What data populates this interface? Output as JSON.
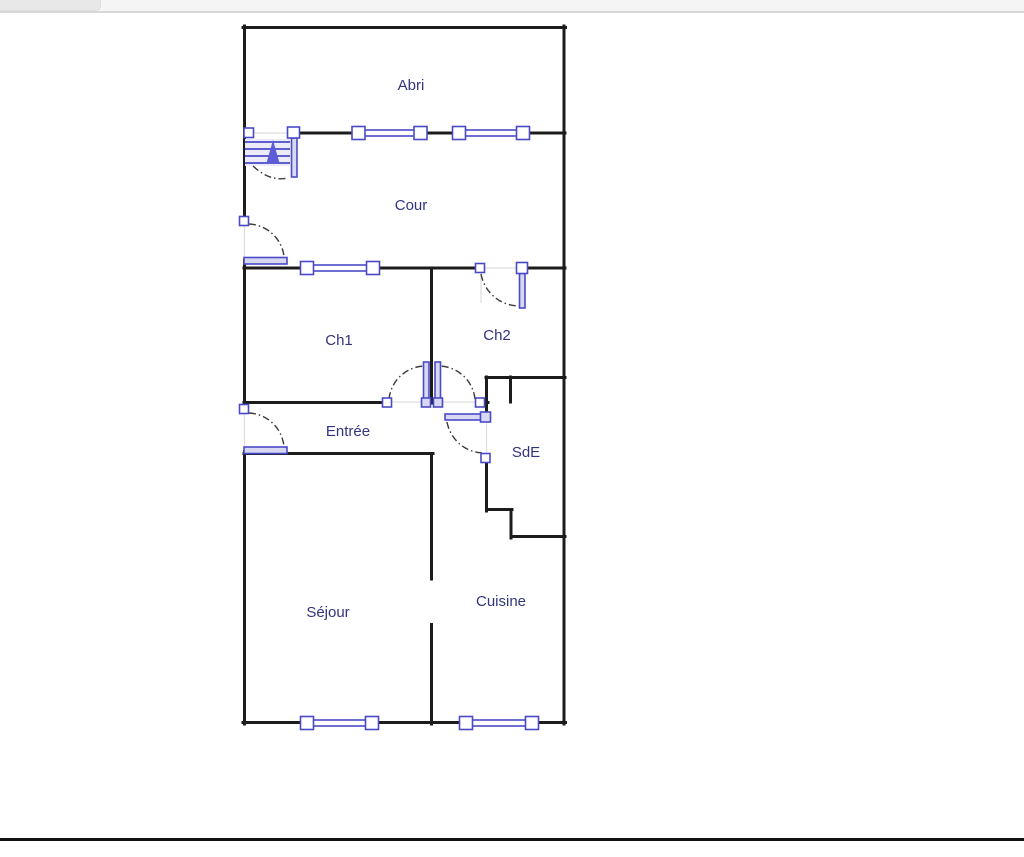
{
  "app": {
    "topbar": {
      "tab_label": ""
    }
  },
  "floorplan": {
    "rooms": [
      {
        "id": "abri",
        "label": "Abri"
      },
      {
        "id": "cour",
        "label": "Cour"
      },
      {
        "id": "ch1",
        "label": "Ch1"
      },
      {
        "id": "ch2",
        "label": "Ch2"
      },
      {
        "id": "entree",
        "label": "Entrée"
      },
      {
        "id": "sde",
        "label": "SdE"
      },
      {
        "id": "sejour",
        "label": "Séjour"
      },
      {
        "id": "cuisine",
        "label": "Cuisine"
      }
    ],
    "colors": {
      "wall": "#1c1c1c",
      "fixture_stroke": "#4a4ac8",
      "fixture_fill": "#d8d8f2",
      "label_text": "#32347f",
      "swing_arc": "#3c3c3c",
      "topbar_bg": "#f5f5f5",
      "tab_bg": "#e8e8e8",
      "divider": "#d8d8d8",
      "footer_line": "#111111"
    }
  }
}
